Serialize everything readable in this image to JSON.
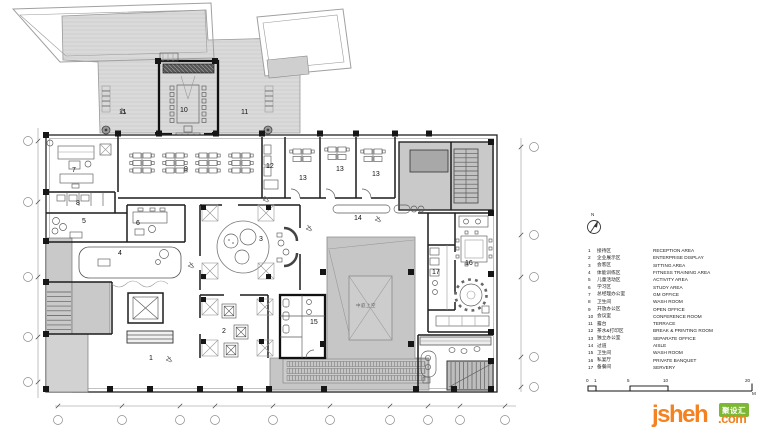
{
  "plan": {
    "courtyard_text": "中庭上空",
    "labels": [
      {
        "text": "11",
        "x": 119,
        "y": 109
      },
      {
        "text": "11",
        "x": 241,
        "y": 109
      },
      {
        "text": "10",
        "x": 180,
        "y": 107
      },
      {
        "text": "7",
        "x": 72,
        "y": 167
      },
      {
        "text": "8",
        "x": 76,
        "y": 200
      },
      {
        "text": "9",
        "x": 184,
        "y": 166
      },
      {
        "text": "12",
        "x": 266,
        "y": 163
      },
      {
        "text": "13",
        "x": 299,
        "y": 175
      },
      {
        "text": "13",
        "x": 336,
        "y": 166
      },
      {
        "text": "13",
        "x": 372,
        "y": 171
      },
      {
        "text": "5",
        "x": 82,
        "y": 218
      },
      {
        "text": "6",
        "x": 136,
        "y": 220
      },
      {
        "text": "4",
        "x": 118,
        "y": 250
      },
      {
        "text": "3",
        "x": 259,
        "y": 236
      },
      {
        "text": "2",
        "x": 222,
        "y": 328
      },
      {
        "text": "1",
        "x": 149,
        "y": 355
      },
      {
        "text": "15",
        "x": 310,
        "y": 319
      },
      {
        "text": "14",
        "x": 354,
        "y": 215
      },
      {
        "text": "16",
        "x": 465,
        "y": 260
      },
      {
        "text": "17",
        "x": 432,
        "y": 269
      }
    ]
  },
  "legend": {
    "north_label": "N",
    "items": [
      {
        "no": "1",
        "zh": "接待区",
        "en": "RECEPTION AREA"
      },
      {
        "no": "2",
        "zh": "企业展示区",
        "en": "ENTERPRISE DISPLAY"
      },
      {
        "no": "3",
        "zh": "会客区",
        "en": "SITTING AREA"
      },
      {
        "no": "4",
        "zh": "体能训练区",
        "en": "FITNESS TRAINING AREA"
      },
      {
        "no": "5",
        "zh": "儿童活动区",
        "en": "ACTIVITY AREA"
      },
      {
        "no": "6",
        "zh": "学习区",
        "en": "STUDY AREA"
      },
      {
        "no": "7",
        "zh": "总经理办公室",
        "en": "GM OFFICE"
      },
      {
        "no": "8",
        "zh": "卫生间",
        "en": "WASH ROOM"
      },
      {
        "no": "9",
        "zh": "开放办公区",
        "en": "OPEN OFFICE"
      },
      {
        "no": "10",
        "zh": "会议室",
        "en": "CONFERENCE ROOM"
      },
      {
        "no": "11",
        "zh": "露台",
        "en": "TERRACE"
      },
      {
        "no": "12",
        "zh": "茶水&打印区",
        "en": "BREAK & PRINTING ROOM"
      },
      {
        "no": "13",
        "zh": "独立办公室",
        "en": "SEPARATE OFFICE"
      },
      {
        "no": "14",
        "zh": "过道",
        "en": "AISLE"
      },
      {
        "no": "15",
        "zh": "卫生间",
        "en": "WASH ROOM"
      },
      {
        "no": "16",
        "zh": "私宴厅",
        "en": "PRIVATE BANQUET"
      },
      {
        "no": "17",
        "zh": "备餐间",
        "en": "SERVERY"
      }
    ],
    "scale": {
      "ticks": [
        {
          "label": "0",
          "x": 586
        },
        {
          "label": "1",
          "x": 594
        },
        {
          "label": "5",
          "x": 627
        },
        {
          "label": "10",
          "x": 663
        },
        {
          "label": "20",
          "x": 745
        }
      ],
      "unit": "M"
    }
  },
  "watermark": {
    "brand": "jsheh",
    "badge": "聚设汇",
    "tld": ".com"
  }
}
